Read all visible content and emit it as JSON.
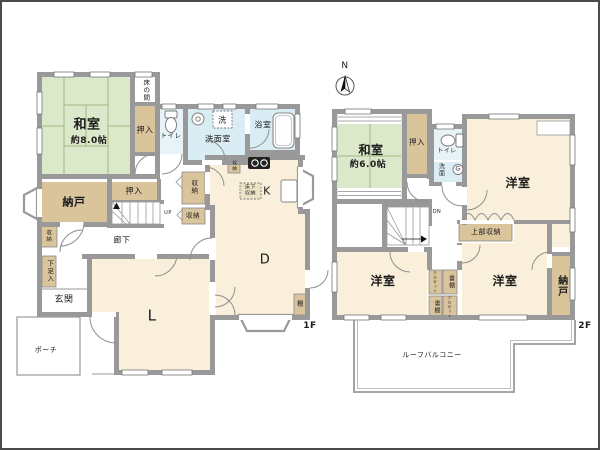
{
  "plan": {
    "type": "floor-plan",
    "floor_tags": [
      "1F",
      "2F"
    ],
    "compass_label": "N"
  },
  "colors": {
    "tatami_green": "#dbe8ca",
    "wood_cream": "#f9efdb",
    "wet_blue": "#daedf5",
    "wet_pale": "#e8f3f8",
    "storage_tan": "#d9c49c",
    "wall_gray": "#999999",
    "line_gray": "#777777",
    "balcony_line": "#9a9a9a",
    "text": "#1b1b1b",
    "frame": "#4a4a4a"
  },
  "labels": [
    {
      "name": "room-label-washitsu-1f",
      "text": "和室",
      "x": 85,
      "y": 124,
      "size": 13,
      "bold": true
    },
    {
      "name": "room-size-washitsu-1f",
      "text": "約8.0帖",
      "x": 87,
      "y": 139,
      "size": 9,
      "bold": true
    },
    {
      "name": "room-label-tokonoma",
      "text": "床の間",
      "x": 143,
      "y": 88,
      "size": 6.5,
      "vertical": true
    },
    {
      "name": "room-label-oshiire-east-1f",
      "text": "押入",
      "x": 143,
      "y": 128,
      "size": 8
    },
    {
      "name": "room-label-toilet-1f",
      "text": "トイレ",
      "x": 169,
      "y": 134,
      "size": 6.5
    },
    {
      "name": "room-label-senmenshitsu",
      "text": "洗面室",
      "x": 216,
      "y": 137,
      "size": 8
    },
    {
      "name": "washer-pan-label",
      "text": "洗",
      "x": 220.5,
      "y": 117.5,
      "size": 8
    },
    {
      "name": "room-label-yokushitsu",
      "text": "浴室",
      "x": 261,
      "y": 123,
      "size": 8
    },
    {
      "name": "room-label-nando-1f",
      "text": "納戸",
      "x": 72,
      "y": 201,
      "size": 11,
      "bold": true
    },
    {
      "name": "room-label-oshiire-south-1f",
      "text": "押入",
      "x": 132,
      "y": 189,
      "size": 8
    },
    {
      "name": "room-label-shuunou-hall-upper",
      "text": "収納",
      "x": 191,
      "y": 185,
      "size": 6.5,
      "vertical": true
    },
    {
      "name": "room-label-shuunou-hall-lower",
      "text": "収納",
      "x": 191,
      "y": 214,
      "size": 6.5
    },
    {
      "name": "room-label-rouka",
      "text": "廊下",
      "x": 120,
      "y": 238,
      "size": 8
    },
    {
      "name": "room-label-shuunou-entry",
      "text": "収納",
      "x": 46,
      "y": 234,
      "size": 5.5,
      "vertical": true
    },
    {
      "name": "room-label-getabako",
      "text": "下足入",
      "x": 47,
      "y": 269,
      "size": 6.5,
      "vertical": true
    },
    {
      "name": "room-label-genkan",
      "text": "玄関",
      "x": 62,
      "y": 298,
      "size": 9
    },
    {
      "name": "room-label-porch",
      "text": "ポーチ",
      "x": 44,
      "y": 348,
      "size": 7
    },
    {
      "name": "room-label-living",
      "text": "L",
      "x": 150,
      "y": 314,
      "size": 15
    },
    {
      "name": "room-label-dining",
      "text": "D",
      "x": 263,
      "y": 259,
      "size": 13
    },
    {
      "name": "room-label-kitchen",
      "text": "K",
      "x": 265,
      "y": 190,
      "size": 11
    },
    {
      "name": "room-label-shuunou-kitchen",
      "text": "収納",
      "x": 232,
      "y": 164,
      "size": 4.5,
      "vertical": true
    },
    {
      "name": "room-label-yukashita-shuunou",
      "text": "床下\n収納",
      "x": 248.5,
      "y": 189,
      "size": 5
    },
    {
      "name": "room-label-tana",
      "text": "棚",
      "x": 298.5,
      "y": 302,
      "size": 6.5
    },
    {
      "name": "stairs-up-label",
      "text": "UP",
      "x": 166,
      "y": 212,
      "size": 5
    },
    {
      "name": "floor1-label",
      "text": "1F",
      "x": 308,
      "y": 324,
      "size": 9,
      "bold": true
    },
    {
      "name": "north-label",
      "text": "N",
      "x": 343,
      "y": 64,
      "size": 9
    },
    {
      "name": "room-label-washitsu-2f",
      "text": "和室",
      "x": 369,
      "y": 149,
      "size": 12,
      "bold": true
    },
    {
      "name": "room-size-washitsu-2f",
      "text": "約6.0帖",
      "x": 366,
      "y": 163,
      "size": 9,
      "bold": true
    },
    {
      "name": "room-label-oshiire-2f",
      "text": "押入",
      "x": 415,
      "y": 141,
      "size": 7.5
    },
    {
      "name": "room-label-toilet-2f",
      "text": "トイレ",
      "x": 445,
      "y": 150,
      "size": 6
    },
    {
      "name": "room-label-senmen-2f",
      "text": "洗面",
      "x": 438,
      "y": 168,
      "size": 6,
      "vertical": true
    },
    {
      "name": "gas-meter-label",
      "text": "G",
      "x": 456,
      "y": 167.5,
      "size": 6
    },
    {
      "name": "room-label-yoshitsu-ne",
      "text": "洋室",
      "x": 516,
      "y": 182,
      "size": 12,
      "bold": true
    },
    {
      "name": "room-label-joubu-shuunou",
      "text": "上部収納",
      "x": 484,
      "y": 230,
      "size": 7
    },
    {
      "name": "stairs-dn-label",
      "text": "DN",
      "x": 435,
      "y": 211,
      "size": 5
    },
    {
      "name": "room-label-yoshitsu-sw",
      "text": "洋室",
      "x": 381,
      "y": 280,
      "size": 12,
      "bold": true
    },
    {
      "name": "room-label-yoshitsu-se",
      "text": "洋室",
      "x": 503,
      "y": 280,
      "size": 12,
      "bold": true
    },
    {
      "name": "room-label-nando-2f",
      "text": "納戸",
      "x": 559,
      "y": 284,
      "size": 10,
      "vertical": true,
      "bold": true
    },
    {
      "name": "room-label-closet-ne",
      "text": "クロゼット",
      "x": 433.5,
      "y": 280,
      "size": 3.5,
      "vertical": true
    },
    {
      "name": "room-label-shodana-ne",
      "text": "書棚",
      "x": 448,
      "y": 280,
      "size": 6,
      "vertical": true
    },
    {
      "name": "room-label-shodana-sw",
      "text": "書棚",
      "x": 433.5,
      "y": 305,
      "size": 6,
      "vertical": true
    },
    {
      "name": "room-label-closet-se",
      "text": "クロゼット",
      "x": 448,
      "y": 305,
      "size": 3.5,
      "vertical": true
    },
    {
      "name": "room-label-roof-balcony",
      "text": "ルーフバルコニー",
      "x": 430,
      "y": 353,
      "size": 7
    },
    {
      "name": "floor2-label",
      "text": "2F",
      "x": 583,
      "y": 324,
      "size": 9,
      "bold": true
    }
  ]
}
